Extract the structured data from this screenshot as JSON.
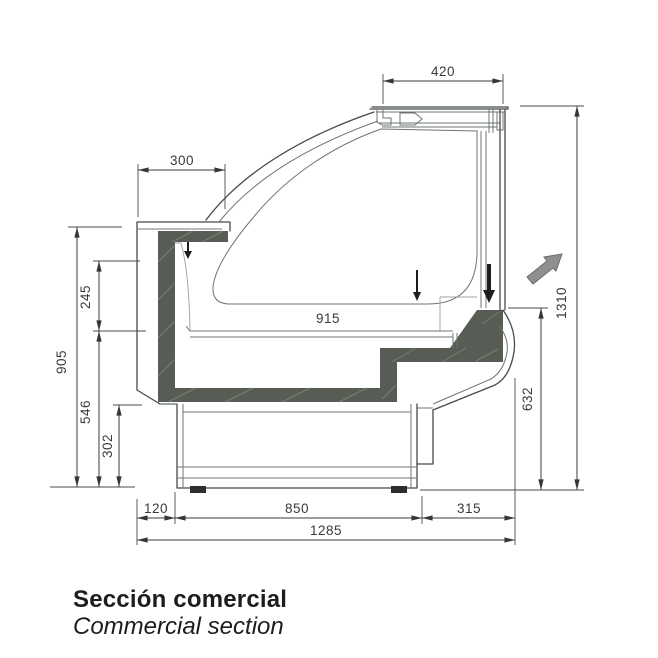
{
  "dims": {
    "top_width": "420",
    "worktop_to_glass": "300",
    "deck_width": "915",
    "total_height": "1310",
    "front_opening_height": "632",
    "worktop_height": "905",
    "worktop_to_deck": "245",
    "deck_height": "546",
    "base_height": "302",
    "rear_overhang": "120",
    "base_depth": "850",
    "front_overhang": "315",
    "total_depth": "1285"
  },
  "caption": {
    "line1": "Sección comercial",
    "line2": "Commercial section"
  },
  "colors": {
    "insulation": "#575d54",
    "flow_arrow_fill": "#8f8f8f",
    "flow_arrow_stroke": "#6c6c6c",
    "airflow": "#1d1d1d"
  }
}
